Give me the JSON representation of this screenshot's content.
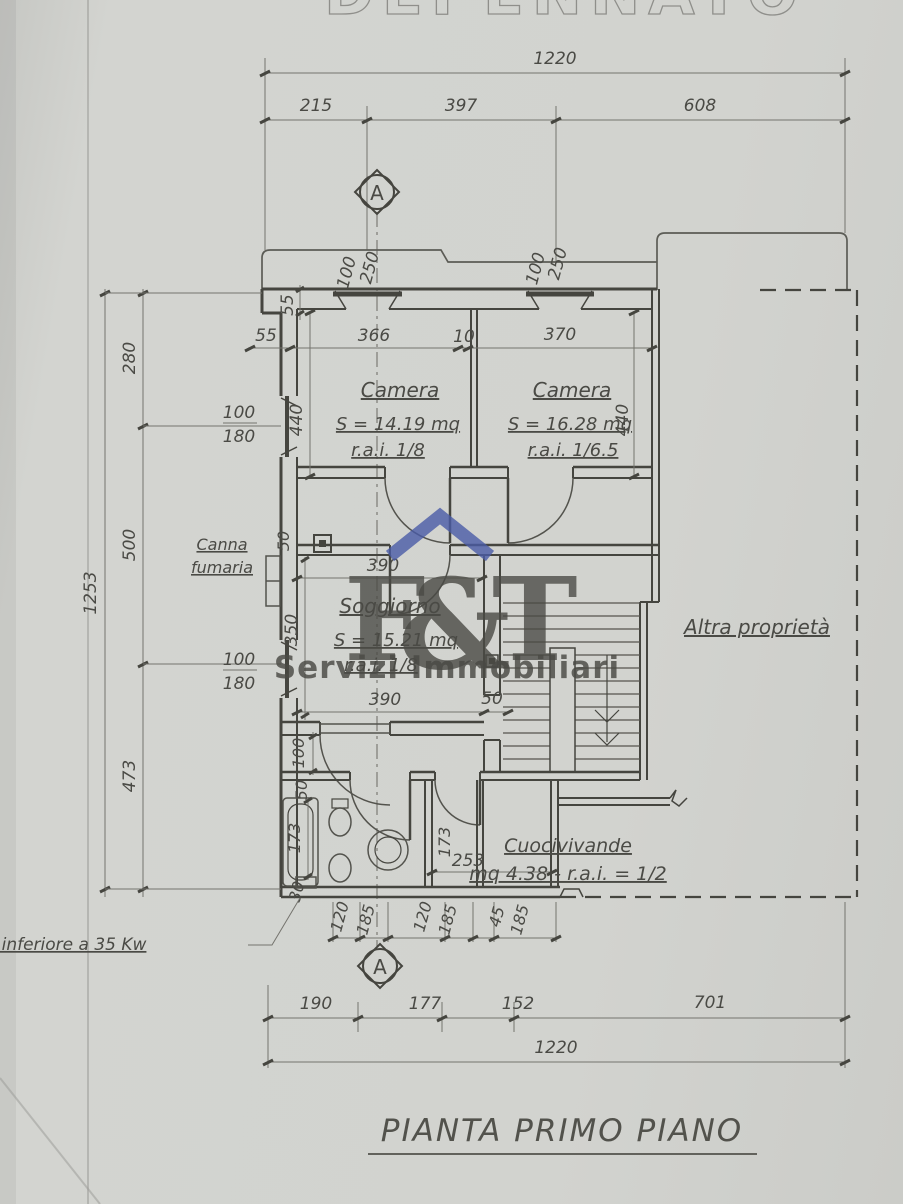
{
  "sheet": {
    "top_clipped_title": "DEPENNATO",
    "drawing_title": "PIANTA PRIMO PIANO"
  },
  "section_marker": "A",
  "watermark": {
    "letter_f": "F",
    "ampersand": "&",
    "letter_t": "T",
    "subtitle": "Servizi Immobiliari",
    "blue": "#4a5ba6",
    "tan": "#c9bda2"
  },
  "rooms": {
    "camera1": {
      "name": "Camera",
      "area": "S = 14.19 mq",
      "rai": "r.a.i. 1/8"
    },
    "camera2": {
      "name": "Camera",
      "area": "S = 16.28 mq",
      "rai": "r.a.i. 1/6.5"
    },
    "soggiorno": {
      "name": "Soggiorno",
      "area": "S = 15.21 mq",
      "rai": "r.a.i. 1/8"
    },
    "cuocivivande": {
      "name": "Cuocivivande",
      "area": "mq 4.38 - r.a.i. = 1/2"
    }
  },
  "annotations": {
    "canna_line1": "Canna",
    "canna_line2": "fumaria",
    "caldaia": "Caldaia a gas inferiore a 35 Kw",
    "altra_proprieta": "Altra proprietà"
  },
  "dimensions": {
    "top_total": "1220",
    "top_segments": [
      "215",
      "397",
      "608"
    ],
    "wall_top": [
      "55",
      "366",
      "10",
      "370"
    ],
    "step": "55",
    "win_top1": [
      "100",
      "250"
    ],
    "win_top2": [
      "100",
      "250"
    ],
    "left_total": "1253",
    "left_segments": [
      "280",
      "500",
      "473"
    ],
    "win_left1": [
      "100",
      "180"
    ],
    "win_left2": [
      "100",
      "180"
    ],
    "camera1_depth": "440",
    "camera2_depth": "440",
    "flue_offset": "50",
    "sogg_top": "390",
    "sogg_height": "350",
    "sogg_bottom": "390",
    "sogg_door": "50",
    "corridor": "100",
    "bath_offset": "50",
    "tub_len": "173",
    "wc_len": "173",
    "passage": "253",
    "edge": "30",
    "bottom_openings": [
      "120",
      "185",
      "120",
      "185",
      "45",
      "185"
    ],
    "bottom_segments": [
      "190",
      "177",
      "152",
      "701"
    ],
    "bottom_total": "1220"
  }
}
